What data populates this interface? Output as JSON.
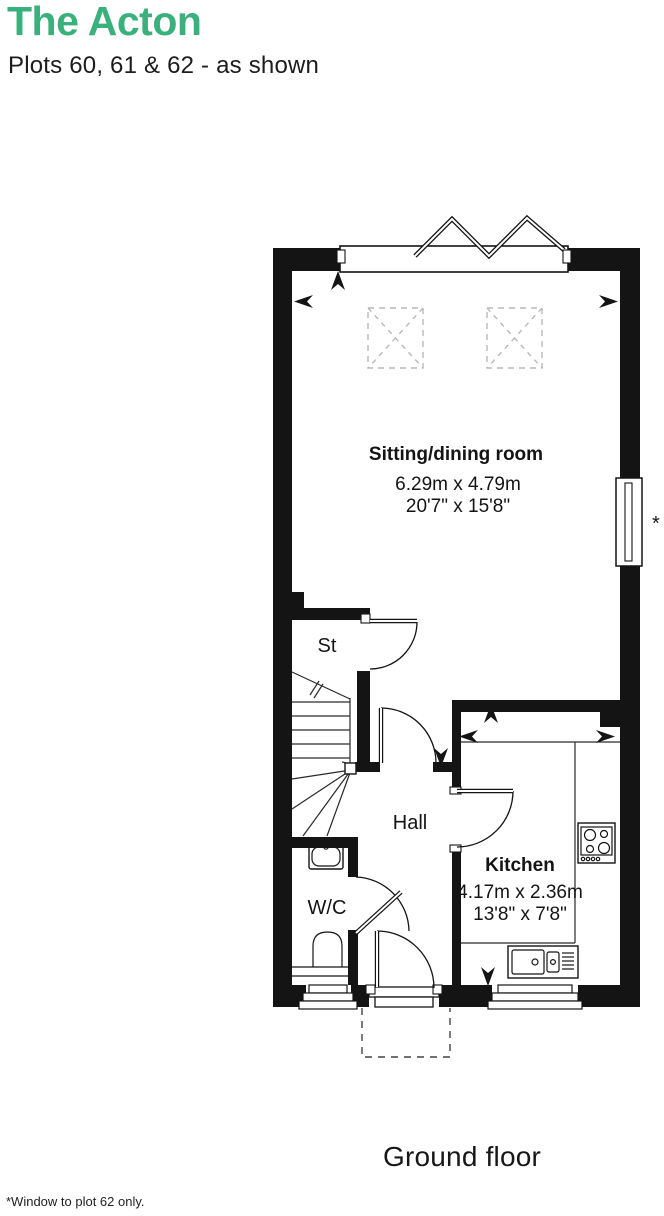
{
  "header": {
    "title": "The Acton",
    "subtitle": "Plots 60, 61 & 62 - as shown"
  },
  "plan": {
    "rooms": [
      {
        "id": "sitting-dining",
        "name": "Sitting/dining room",
        "metric": "6.29m x 4.79m",
        "imperial": "20'7\" x 15'8\""
      },
      {
        "id": "kitchen",
        "name": "Kitchen",
        "metric": "4.17m x 2.36m",
        "imperial": "13'8\" x 7'8\""
      },
      {
        "id": "hall",
        "name": "Hall"
      },
      {
        "id": "store",
        "name": "St"
      },
      {
        "id": "wc",
        "name": "W/C"
      }
    ],
    "window_note_marker": "*",
    "fixtures": [
      "bifold-door",
      "rooflight",
      "rooflight",
      "window",
      "staircase",
      "hob-icon",
      "sink-icon",
      "basin-icon",
      "toilet-icon",
      "front-door-canopy"
    ]
  },
  "footer": {
    "floor_label": "Ground floor",
    "footnote": "*Window to plot 62 only."
  },
  "colors": {
    "accent_green": "#3ab17d",
    "ink": "#141414",
    "rooflight_dash": "#b8b8b8"
  }
}
